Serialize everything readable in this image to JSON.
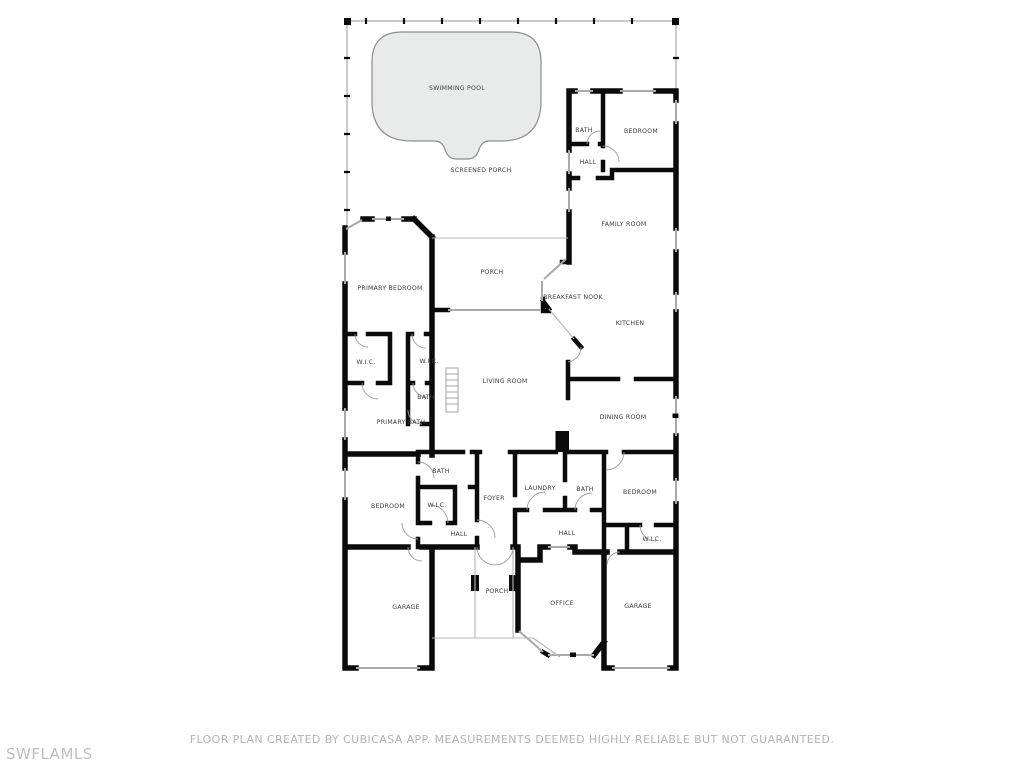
{
  "rooms": {
    "swimming_pool": "SWIMMING POOL",
    "screened_porch": "SCREENED PORCH",
    "bath_1": "BATH",
    "bedroom_1": "BEDROOM",
    "hall_1": "HALL",
    "family_room": "FAMILY ROOM",
    "primary_bedroom": "PRIMARY BEDROOM",
    "porch_upper": "PORCH",
    "breakfast_nook": "BREAKFAST NOOK",
    "kitchen": "KITCHEN",
    "wic_1": "W.I.C.",
    "wic_2": "W.I.C.",
    "living_room": "LIVING ROOM",
    "bath_2": "BATH",
    "primary_bath": "PRIMARY BATH",
    "dining_room": "DINING ROOM",
    "bath_3": "BATH",
    "bedroom_2": "BEDROOM",
    "wic_3": "W.I.C.",
    "foyer": "FOYER",
    "laundry": "LAUNDRY",
    "bath_4": "BATH",
    "bedroom_3": "BEDROOM",
    "hall_2": "HALL",
    "hall_3": "HALL",
    "wic_4": "W.I.C.",
    "garage_left": "GARAGE",
    "porch_lower": "PORCH",
    "office": "OFFICE",
    "garage_right": "GARAGE"
  },
  "footer": {
    "disclaimer": "FLOOR PLAN CREATED BY CUBICASA APP. MEASUREMENTS DEEMED HIGHLY RELIABLE BUT NOT GUARANTEED.",
    "watermark": "SWFLAMLS"
  },
  "colors": {
    "wall": "#0b0b0b",
    "screen_line": "#b5b5b5",
    "pool_fill": "#e9eaea",
    "pool_border": "#8d8d8d",
    "label_text": "#3b3b3b",
    "disclaimer_text": "#b3b3b3",
    "watermark_text": "#bfbfbf",
    "background": "#ffffff"
  }
}
